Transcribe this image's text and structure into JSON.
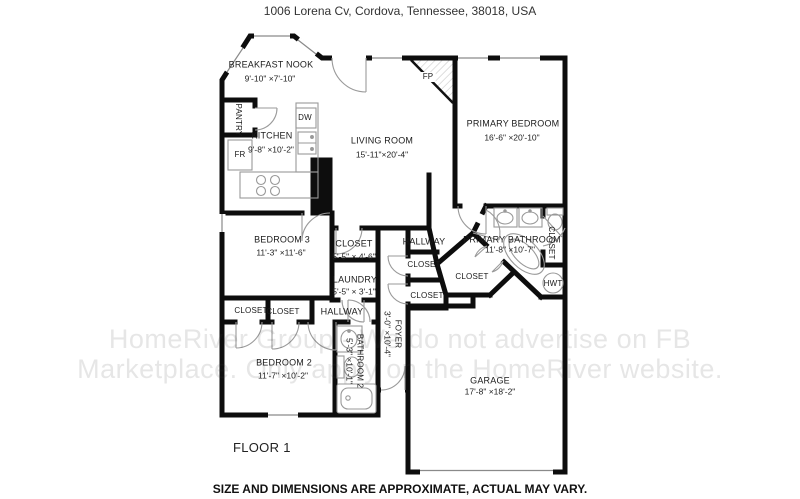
{
  "header": {
    "title": "1006 Lorena Cv, Cordova, Tennessee, 38018, USA"
  },
  "footer": {
    "disclaimer": "SIZE AND DIMENSIONS ARE APPROXIMATE, ACTUAL MAY VARY.",
    "floor_label": "FLOOR 1"
  },
  "watermark": {
    "line1": "HomeRiver Group - We do not advertise on FB",
    "line2": "Marketplace. Only apply on the HomeRiver website."
  },
  "rooms": {
    "breakfast_nook": {
      "name": "BREAKFAST NOOK",
      "dims": "9'-10\" ×7'-10\""
    },
    "kitchen": {
      "name": "KITCHEN",
      "dims": "9'-8\"  ×10'-2\""
    },
    "living_room": {
      "name": "LIVING ROOM",
      "dims": "15'-11\"×20'-4\""
    },
    "primary_bedroom": {
      "name": "PRIMARY BEDROOM",
      "dims": "16'-6\" ×20'-10\""
    },
    "bedroom_3": {
      "name": "BEDROOM 3",
      "dims": "11'-3\" ×11'-6\""
    },
    "closet_bedroom3": {
      "name": "CLOSET",
      "dims": "5'-5\" × 4'-6\""
    },
    "laundry": {
      "name": "LAUNDRY",
      "dims": "5'-5\" × 3'-1\""
    },
    "hallway_upper": {
      "name": "HALLWAY"
    },
    "primary_bathroom": {
      "name": "PRIMARY BATHROOM",
      "dims": "11'-8\" ×10'-7\""
    },
    "closet_linen": {
      "name": "CLOSET"
    },
    "closet_walkin": {
      "name": "CLOSET"
    },
    "closet_foyer_upper": {
      "name": "CLOSET"
    },
    "closet_foyer_lower": {
      "name": "CLOSET"
    },
    "hallway_lower": {
      "name": "HALLWAY"
    },
    "closet_bedroom2_left": {
      "name": "CLOSET"
    },
    "closet_bedroom2_right": {
      "name": "CLOSET"
    },
    "bedroom_2": {
      "name": "BEDROOM 2",
      "dims": "11'-7\" ×10'-2\""
    },
    "bathroom_2": {
      "name": "BATHROOM 2",
      "dims": "5'-3\" ×10'-1\""
    },
    "foyer": {
      "name": "FOYER",
      "dims": "3'-0\" ×10'-4\""
    },
    "garage": {
      "name": "GARAGE",
      "dims": "17'-8\" ×18'-2\""
    }
  },
  "fixtures": {
    "pantry": "PANTRY",
    "fridge": "FR",
    "dishwasher": "DW",
    "fireplace": "FP",
    "water_heater": "HWT"
  },
  "colors": {
    "wall": "#0d0d0d",
    "thin_line": "#999999",
    "text": "#1b1b1b",
    "watermark": "rgba(60,60,60,0.13)"
  }
}
